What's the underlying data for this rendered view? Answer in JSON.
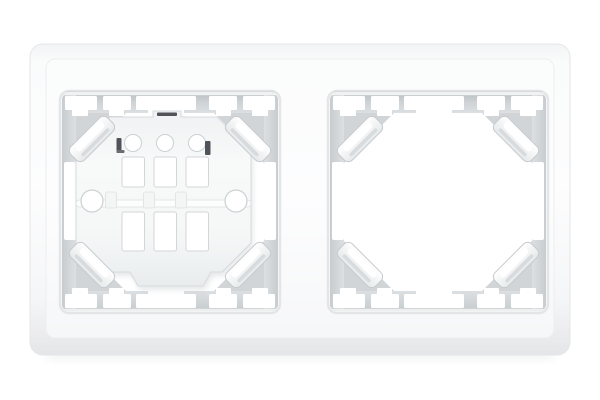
{
  "scene": {
    "type": "product-photo",
    "subject": "white two-gang electrical switch frame (double wall plate)",
    "background": "plain white studio background",
    "left_opening": "contains installed switch mounting bracket with screw holes and slots",
    "right_opening": "empty frame opening showing four corner retaining clips"
  },
  "counts": {
    "openings": 2,
    "corner_clips_per_opening": 4,
    "bracket_screw_holes": 2,
    "bracket_round_holes": 3,
    "bracket_rect_slots": 6,
    "edge_notches_per_band": 5
  },
  "colors": {
    "background": "#ffffff",
    "frame_face": "#fdfdfe",
    "frame_edge": "#e4e6e7",
    "wall_dark": "#bac0c4",
    "wall_mid": "#ced2d5",
    "wall_light": "#dde0e2",
    "wall_corner": "#d1d5d8",
    "plate_light": "#f8fafa",
    "plate_shade": "#e9eced",
    "plate_stroke": "#d7dbdd",
    "clip_stroke": "#c6cacd",
    "slot_dark": "#50545a",
    "shadow_tint": "#dfe2e3"
  }
}
